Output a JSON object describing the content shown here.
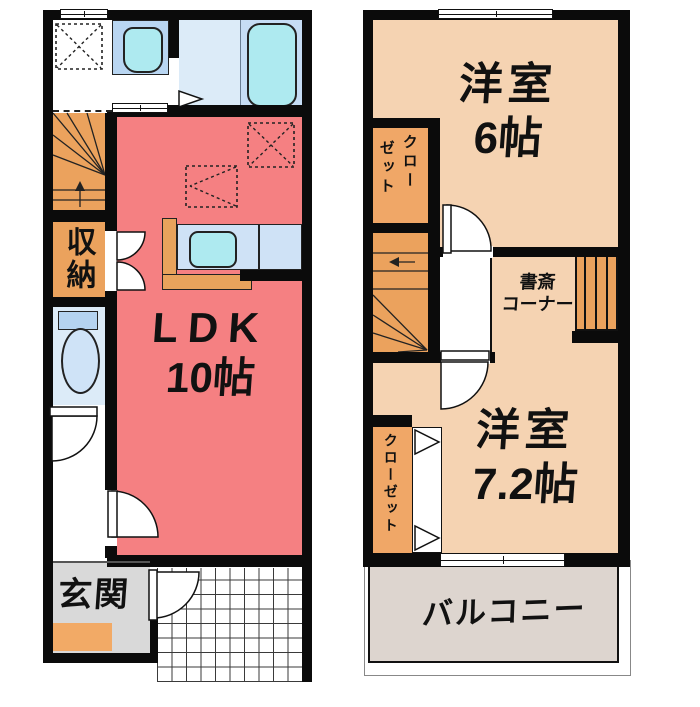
{
  "document": {
    "type": "floor-plan",
    "floors": 2
  },
  "palette": {
    "wall": "#0b0b0b",
    "ldk_fill": "#f58082",
    "western_room_fill": "#f5d3b2",
    "stairs_orange": "#eba25d",
    "closet_orange": "#f0a767",
    "entrance_gray": "#d9d9d9",
    "balcony_gray": "#ddd5cf",
    "wet_room_blue": "#dcebf8",
    "fixture_panel_blue": "#b9d6f2",
    "fixture_aqua": "#aeeaf0"
  },
  "icons": {
    "washing_machine_space": "dashed-square-with-x",
    "refrigerator_space": "dashed-square-with-x",
    "cupboard_space": "dashed-rect-with-triangle",
    "door_swing": "quarter-arc",
    "folding_door": "triangle-pair",
    "window": "double-line"
  },
  "floor1": {
    "ldk_label": "LDK",
    "ldk_size": "10帖",
    "storage_label": "収納",
    "entrance_label": "玄関"
  },
  "floor2": {
    "room6_label": "洋室",
    "room6_size": "6帖",
    "closet_upper_col_right": "クロー",
    "closet_upper_col_left": "ゼット",
    "study_line1": "書斎",
    "study_line2": "コーナー",
    "room72_label": "洋室",
    "room72_size": "7.2帖",
    "closet_lower_label": "クローゼット",
    "balcony_label": "バルコニー"
  }
}
